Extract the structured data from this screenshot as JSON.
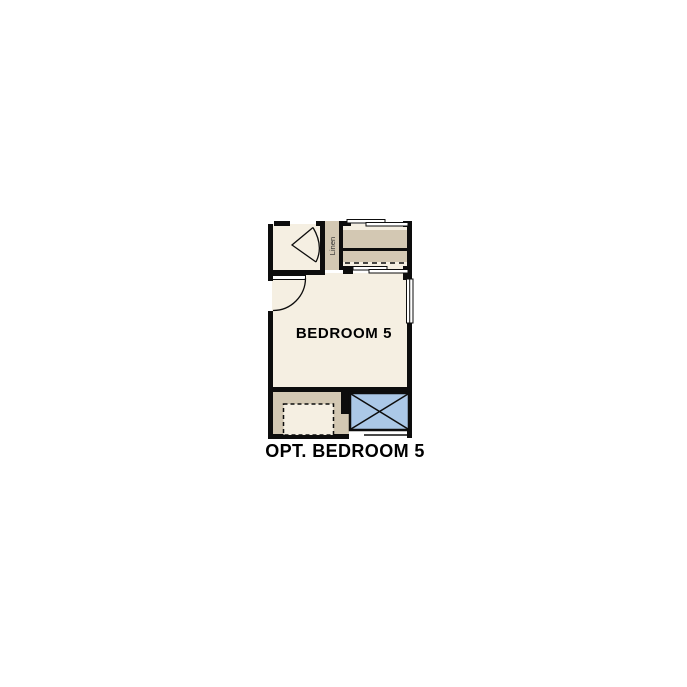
{
  "figure": {
    "caption": "OPT. BEDROOM 5",
    "bedroom_label": "BEDROOM 5",
    "linen_label": "Linen",
    "colors": {
      "page": "#ffffff",
      "floor": "#f5efe2",
      "tan": "#d3c8b3",
      "blue": "#abc8e7",
      "wall": "#0d0d0d",
      "text": "#000000"
    }
  }
}
